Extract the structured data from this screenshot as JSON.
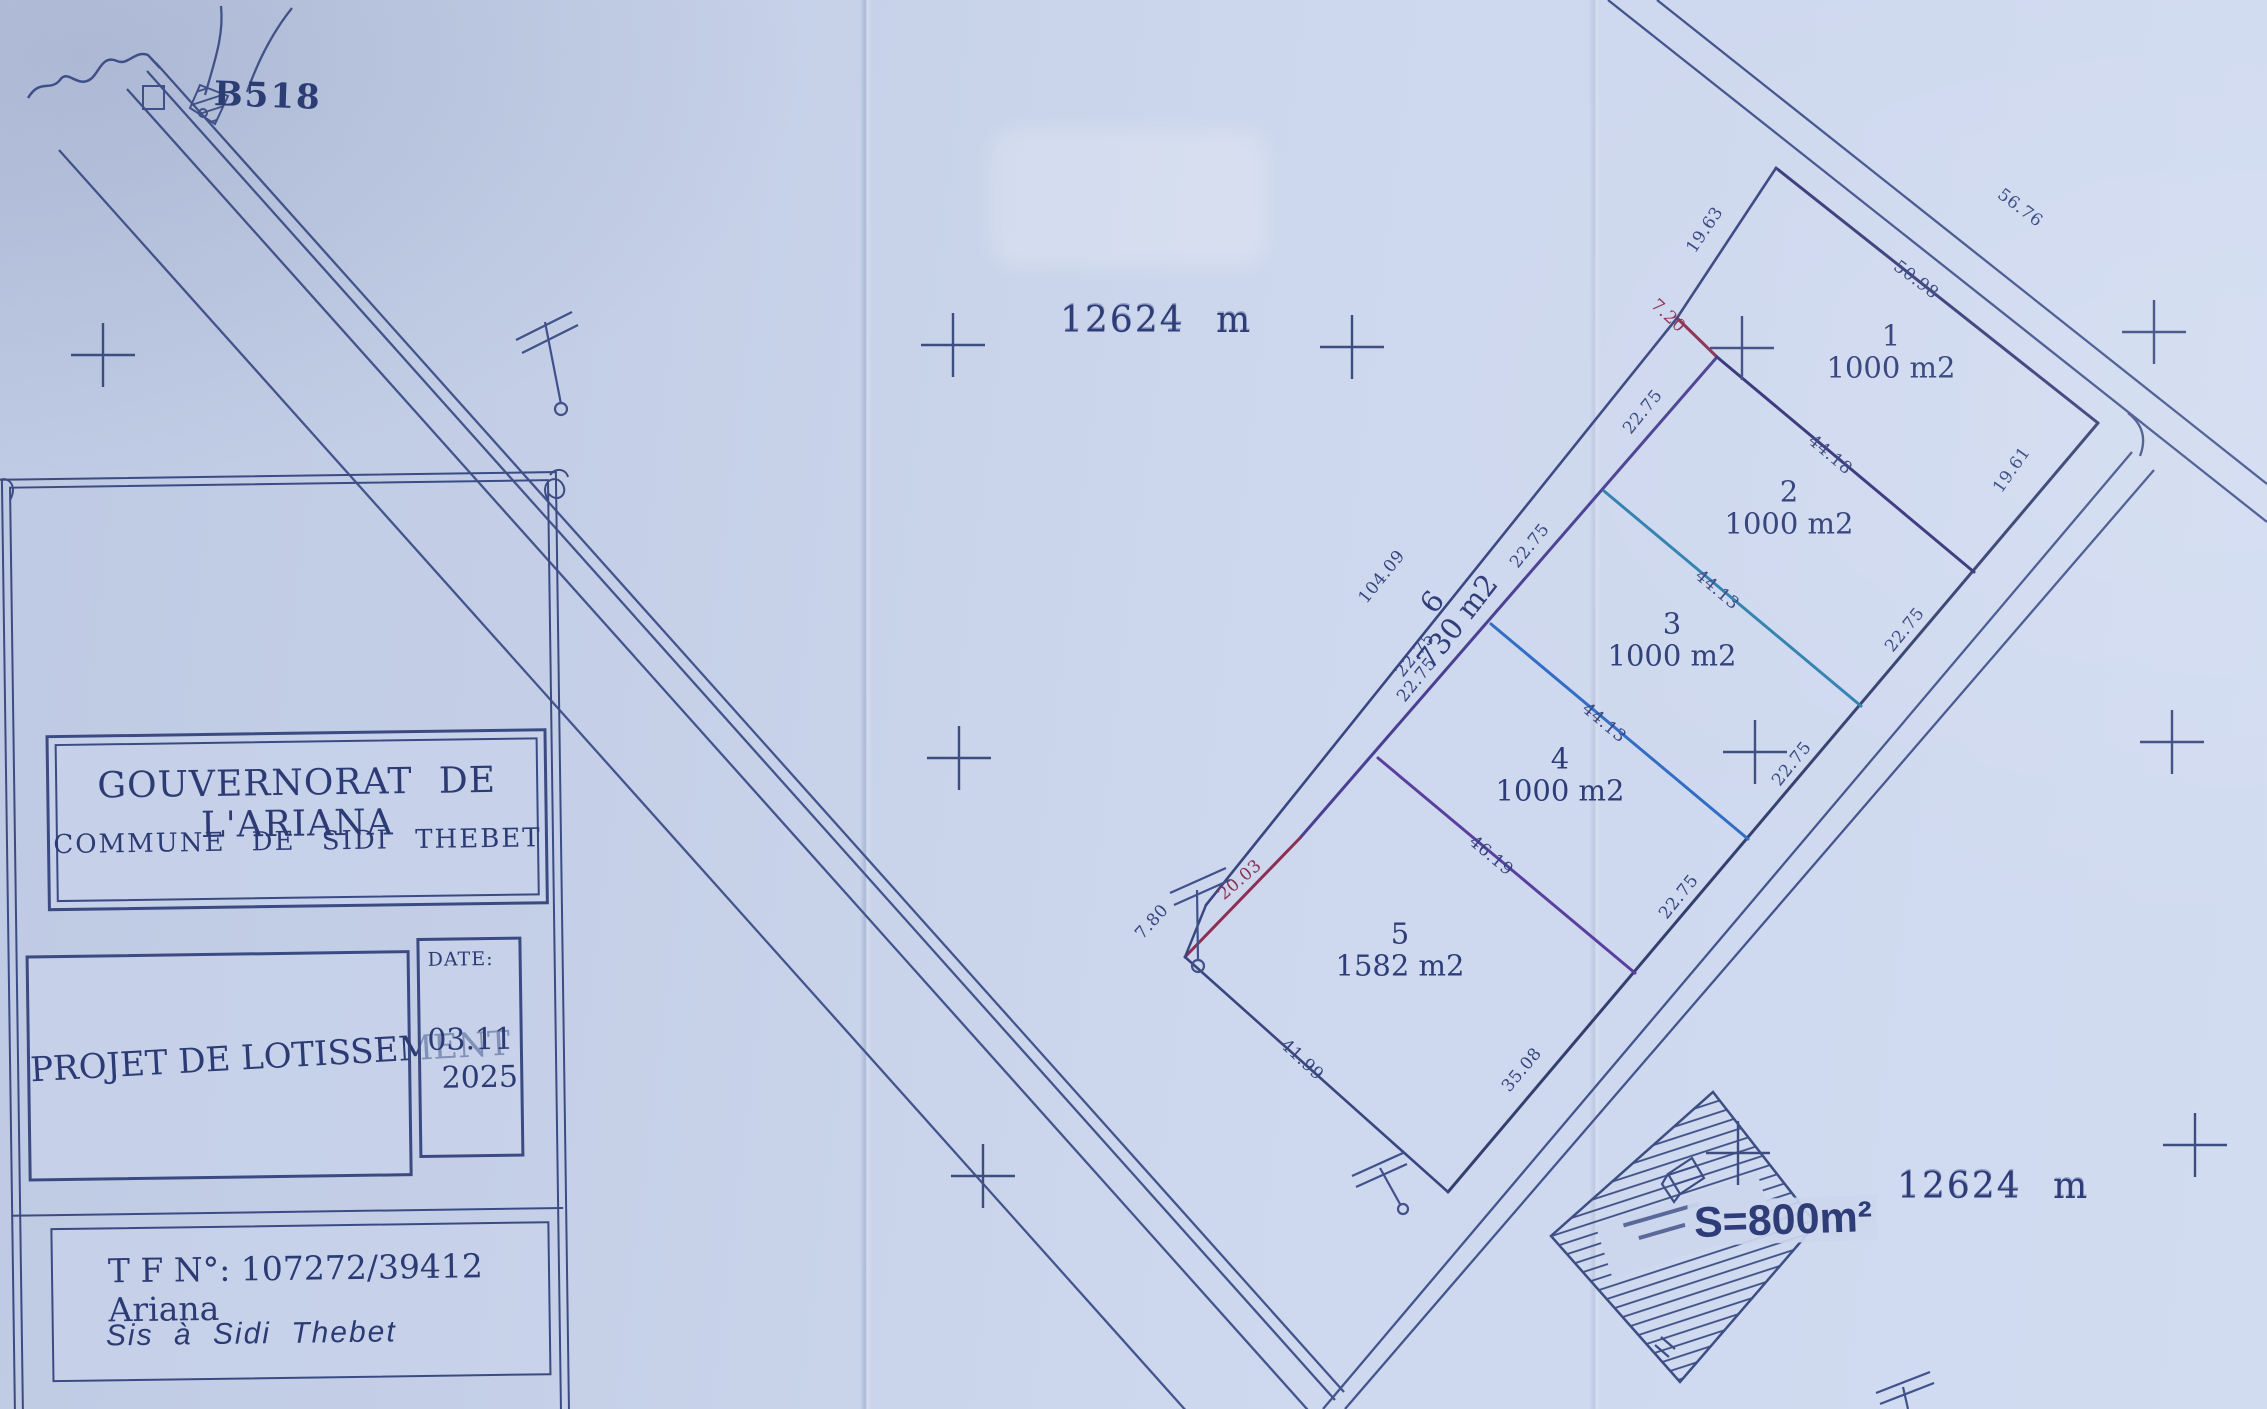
{
  "map": {
    "road_label": "B518",
    "boundary_length_top": "12624 m",
    "boundary_length_bottom": "12624 m",
    "equipment_area_label": "S=800m²",
    "lots": [
      {
        "num": "1",
        "area": "1000 m2",
        "x": 1891,
        "y": 352,
        "rot": 0
      },
      {
        "num": "2",
        "area": "1000 m2",
        "x": 1789,
        "y": 508,
        "rot": 0
      },
      {
        "num": "3",
        "area": "1000 m2",
        "x": 1672,
        "y": 640,
        "rot": 0
      },
      {
        "num": "4",
        "area": "1000 m2",
        "x": 1560,
        "y": 775,
        "rot": 0
      },
      {
        "num": "5",
        "area": "1582 m2",
        "x": 1400,
        "y": 950,
        "rot": 0
      },
      {
        "num": "6",
        "area": "730 m2",
        "x": 1445,
        "y": 612,
        "rot": -52
      }
    ],
    "dimensions": [
      {
        "t": "19.63",
        "x": 1705,
        "y": 230,
        "r": -56
      },
      {
        "t": "7.20",
        "x": 1668,
        "y": 316,
        "r": 43,
        "c": "red"
      },
      {
        "t": "50.98",
        "x": 1916,
        "y": 280,
        "r": 37
      },
      {
        "t": "56.76",
        "x": 2020,
        "y": 208,
        "r": 37
      },
      {
        "t": "44.18",
        "x": 1830,
        "y": 455,
        "r": 40
      },
      {
        "t": "22.75",
        "x": 1643,
        "y": 412,
        "r": -51
      },
      {
        "t": "44.13",
        "x": 1717,
        "y": 590,
        "r": 40
      },
      {
        "t": "22.75",
        "x": 1530,
        "y": 546,
        "r": -51
      },
      {
        "t": "44.13",
        "x": 1604,
        "y": 723,
        "r": 40
      },
      {
        "t": "22.75",
        "x": 1417,
        "y": 680,
        "r": -51
      },
      {
        "t": "46.19",
        "x": 1491,
        "y": 856,
        "r": 40
      },
      {
        "t": "22.75",
        "x": 1905,
        "y": 630,
        "r": -51
      },
      {
        "t": "22.75",
        "x": 1792,
        "y": 764,
        "r": -51
      },
      {
        "t": "22.75",
        "x": 1679,
        "y": 897,
        "r": -51
      },
      {
        "t": "104.09",
        "x": 1382,
        "y": 577,
        "r": -51
      },
      {
        "t": "22.75",
        "x": 1415,
        "y": 655,
        "r": -51
      },
      {
        "t": "20.03",
        "x": 1240,
        "y": 880,
        "r": -41,
        "c": "red"
      },
      {
        "t": "7.80",
        "x": 1152,
        "y": 922,
        "r": -48
      },
      {
        "t": "41.99",
        "x": 1302,
        "y": 1060,
        "r": 43
      },
      {
        "t": "35.08",
        "x": 1522,
        "y": 1070,
        "r": -50
      },
      {
        "t": "19.61",
        "x": 2012,
        "y": 470,
        "r": -55
      }
    ],
    "survey_crosses": [
      [
        103,
        355
      ],
      [
        953,
        345
      ],
      [
        1352,
        347
      ],
      [
        1742,
        348
      ],
      [
        2154,
        332
      ],
      [
        959,
        758
      ],
      [
        1755,
        752
      ],
      [
        2172,
        742
      ],
      [
        983,
        1176
      ],
      [
        1738,
        1153
      ],
      [
        2195,
        1145
      ]
    ]
  },
  "title_block": {
    "authority": "GOUVERNORAT DE L'ARIANA",
    "commune": "COMMUNE DE SIDI THEBET",
    "project": "PROJET DE LOTISSEMENT",
    "date_label": "DATE:",
    "date_month": "03.11",
    "date_year": "2025",
    "tf": "T F N°: 107272/39412 Ariana",
    "location": "Sis à Sidi Thebet"
  }
}
